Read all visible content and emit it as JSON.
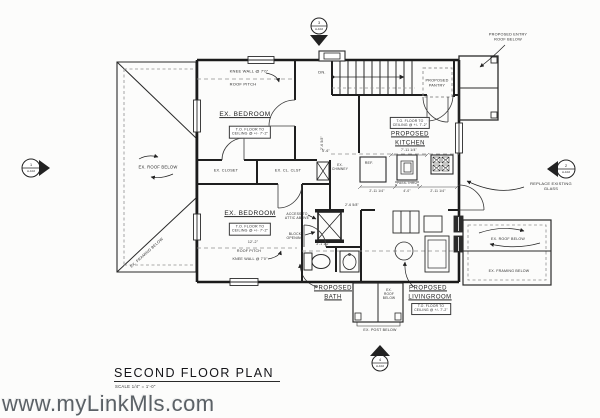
{
  "title_block": {
    "title": "SECOND FLOOR PLAN",
    "scale": "SCALE 1/4\" = 1'-0\""
  },
  "watermark": "www.myLinkMls.com",
  "markers": {
    "top": {
      "number": "3",
      "sheet": "A-102"
    },
    "left": {
      "number": "1",
      "sheet": "A-102"
    },
    "right": {
      "number": "2",
      "sheet": "A-102"
    },
    "bottom": {
      "number": "4",
      "sheet": "A-102"
    }
  },
  "rooms": {
    "bedroom_top": {
      "name": "EX. BEDROOM",
      "ceiling": "T.O. FLOOR TO\nCEILING @ +/- 7'-2\""
    },
    "bedroom_bottom": {
      "name": "EX. BEDROOM",
      "ceiling": "T.O. FLOOR TO\nCEILING @ +/- 7'-2\""
    },
    "kitchen": {
      "line1": "PROPOSED",
      "line2": "KITCHEN",
      "ceiling": "T.O. FLOOR TO\nCEILING @ +/- 7'-2\""
    },
    "bath": {
      "line1": "PROPOSED",
      "line2": "BATH"
    },
    "livingroom": {
      "line1": "PROPOSED",
      "line2": "LIVINGROOM",
      "ceiling": "T.O. FLOOR TO\nCEILING @ +/- 7'-2\""
    },
    "pantry": {
      "name": "PROPOSED\nPANTRY"
    },
    "closet_a": {
      "name": "EX. CLOSET"
    },
    "closet_b": {
      "name": "EX. CL. CLST"
    }
  },
  "annotations": {
    "knee_wall_top": "KNEE WALL @ 7'0\"",
    "roof_pitch_top": "ROOF PITCH",
    "ex_chimney": "EX.\nCHIMNEY",
    "ex_roof_below_left": "EX. ROOF BELOW",
    "ex_framing_below_left": "EX. FRAMING BELOW",
    "roof_pitch_bottom": "ROOF PITCH",
    "knee_wall_bottom": "KNEE WALL @ 7'0\"",
    "access_attic": "ACCESS TO\nATTIC ABOVE",
    "block_opening": "BLOCK\nOPENING",
    "dn": "DN.",
    "proposed_entry": "PROPOSED ENTRY\nROOF BELOW",
    "ref": "REF.",
    "pass_thru": "PASS-THRU",
    "replace_glass": "REPLACE EXISTING GLASS",
    "ex_roof_below_right": "EX. ROOF BELOW",
    "ex_framing_below_right": "EX. FRAMING BELOW",
    "ex_roof_below_bottom": "EX.\nROOF\nBELOW",
    "ex_post_below": "EX. POST BELOW"
  },
  "dimensions": {
    "d12_2": "12'-2\"",
    "d2_6": "2'-6 5/8\"",
    "d3_1": "3'-1 1/2\"",
    "d7_11": "7'-11 1/4\"",
    "d5_6": "5'-6\"",
    "d2_11a": "2'-11 1/4\"",
    "d4_0": "4'-0\"",
    "d2_11b": "2'-11 1/4\"",
    "d2_6v": "2'-6 5/8\""
  }
}
